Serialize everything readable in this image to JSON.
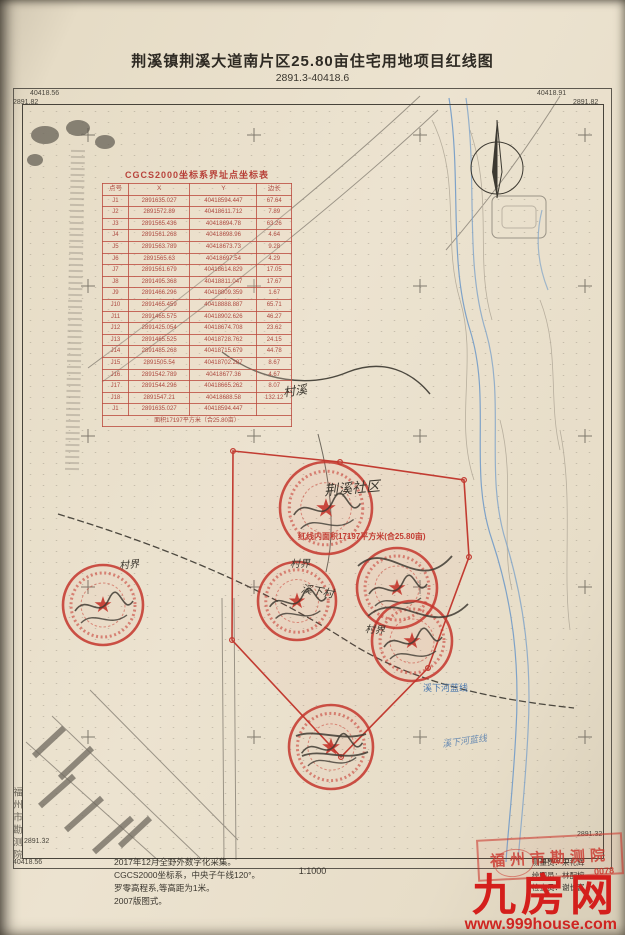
{
  "page": {
    "title": "荆溪镇荆溪大道南片区25.80亩住宅用地项目红线图",
    "subtitle": "2891.3-40418.6",
    "scale": "1:1000",
    "side_text": "福州市勘测院"
  },
  "frame_corners": {
    "top_left_e": "40418.56",
    "top_left_n": "2891.82",
    "top_right_e": "40418.91",
    "top_right_n": "2891.82",
    "bottom_left_n": "2891.32",
    "bottom_left_e": "40418.56",
    "bottom_right_n": "2891.32",
    "bottom_right_e": "40418.91"
  },
  "coordinate_table": {
    "title": "CGCS2000坐标系界址点坐标表",
    "headers": [
      "点号",
      "X",
      "Y",
      "边长"
    ],
    "rows": [
      [
        "J1",
        "2891635.027",
        "40418594.447",
        "67.64"
      ],
      [
        "J2",
        "2891572.89",
        "40418611.712",
        "7.89"
      ],
      [
        "J3",
        "2891565.436",
        "40418694.78",
        "63.26"
      ],
      [
        "J4",
        "2891561.268",
        "40418698.96",
        "4.64"
      ],
      [
        "J5",
        "2891563.789",
        "40418673.73",
        "9.28"
      ],
      [
        "J6",
        "2891565.63",
        "40418697.54",
        "4.29"
      ],
      [
        "J7",
        "2891561.679",
        "40418614.829",
        "17.05"
      ],
      [
        "J8",
        "2891495.368",
        "40418811.047",
        "17.67"
      ],
      [
        "J9",
        "2891466.296",
        "40418809.359",
        "1.67"
      ],
      [
        "J10",
        "2891465.459",
        "40418888.887",
        "65.71"
      ],
      [
        "J11",
        "2891465.575",
        "40418902.626",
        "46.27"
      ],
      [
        "J12",
        "2891425.054",
        "40418674.708",
        "23.62"
      ],
      [
        "J13",
        "2891465.525",
        "40418728.762",
        "24.15"
      ],
      [
        "J14",
        "2891485.268",
        "40418715.679",
        "44.78"
      ],
      [
        "J15",
        "2891505.54",
        "40418702.287",
        "8.67"
      ],
      [
        "J16",
        "2891542.789",
        "40418677.36",
        "4.67"
      ],
      [
        "J17",
        "2891544.296",
        "40418665.262",
        "8.07"
      ],
      [
        "J18",
        "2891547.21",
        "40418688.58",
        "132.12"
      ],
      [
        "J1",
        "2891635.027",
        "40418594.447",
        ""
      ]
    ],
    "footer": "面积17197平方米（合25.80亩）"
  },
  "map_labels": {
    "area_note": "红线内面积17197平方米(合25.80亩)",
    "community": "荆溪社区",
    "creek": "村溪",
    "boundary": "村界",
    "village": "溪下村",
    "blueline": "溪下河蓝线"
  },
  "notes": {
    "lines": [
      "2017年12月全野外数字化采集。",
      "CGCS2000坐标系，中央子午线120°。",
      "罗零高程系,等高距为1米。",
      "2007版图式。"
    ]
  },
  "credits": {
    "rows": [
      {
        "label": "测量员：",
        "name": "宋礼辉"
      },
      {
        "label": "绘图员：",
        "name": "林配榕"
      },
      {
        "label": "检查员：",
        "name": "谢长富"
      }
    ]
  },
  "stamps": {
    "institute": "福州市勘测院",
    "number": "0078"
  },
  "watermark": {
    "logo": "九房网",
    "url": "www.999house.com"
  },
  "colors": {
    "redline": "#c23b31",
    "blueline": "#7ea2c8",
    "paper": "#ece3d0"
  }
}
